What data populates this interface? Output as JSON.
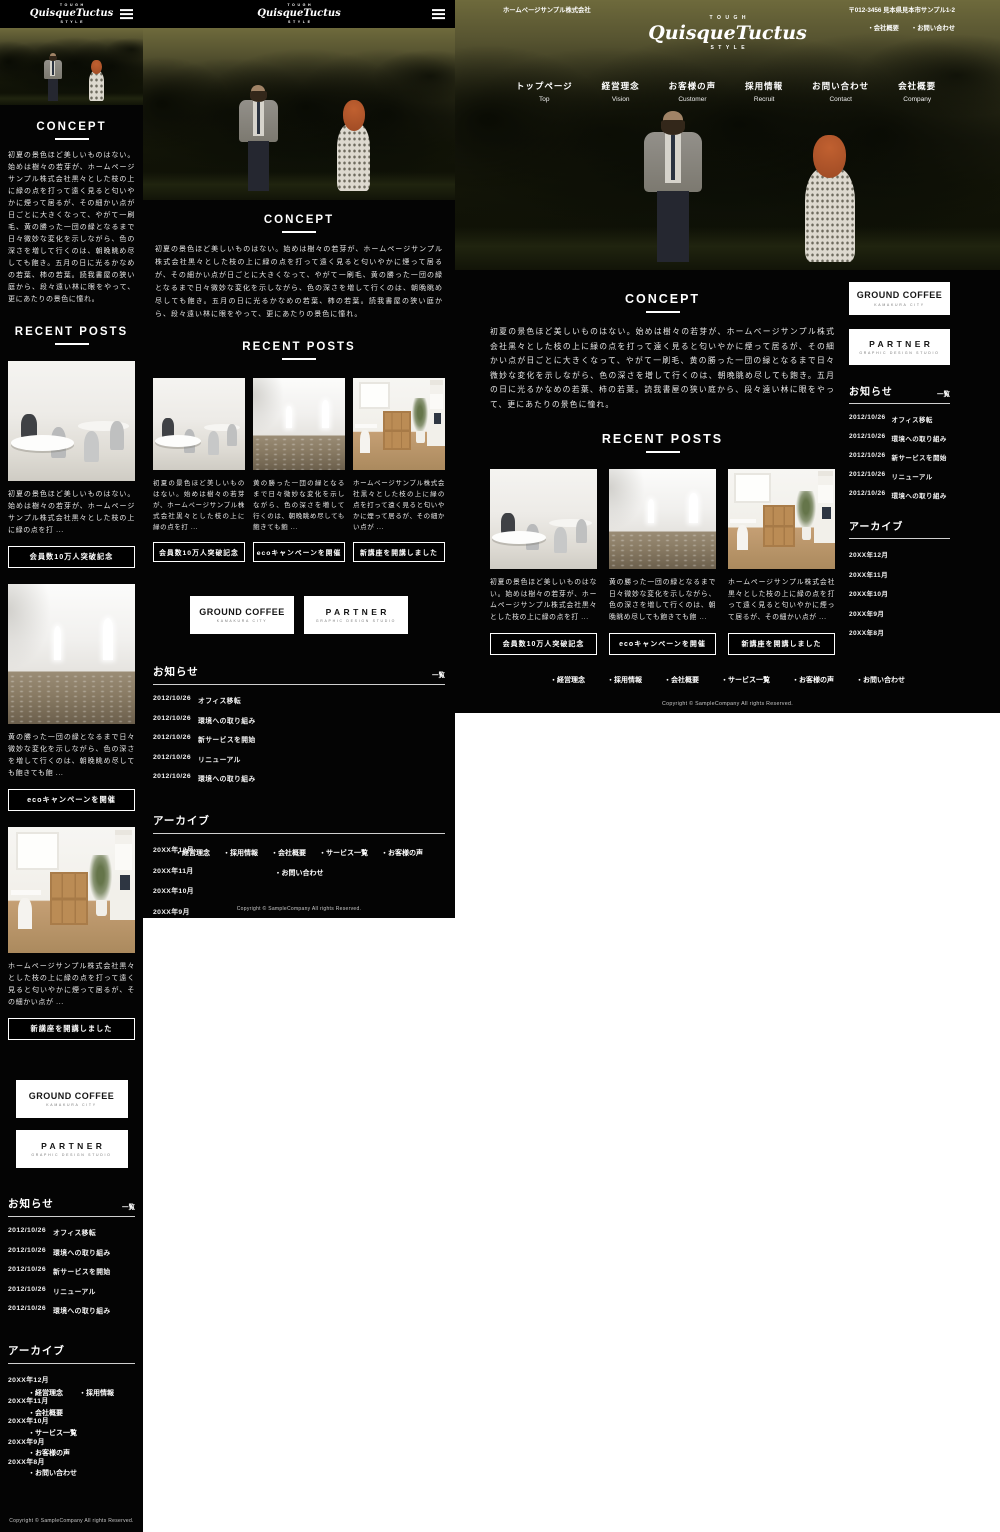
{
  "site": {
    "bullet": "・",
    "logo": {
      "top": "TOUGH",
      "name": "QuisqueTuctus",
      "bottom": "STYLE"
    },
    "header": {
      "company": "ホームページサンプル株式会社",
      "address": "〒012-3456 見本県見本市サンプル1-2",
      "links": [
        "会社概要",
        "お問い合わせ"
      ]
    },
    "nav": [
      {
        "jp": "トップページ",
        "en": "Top"
      },
      {
        "jp": "経営理念",
        "en": "Vision"
      },
      {
        "jp": "お客様の声",
        "en": "Customer"
      },
      {
        "jp": "採用情報",
        "en": "Recruit"
      },
      {
        "jp": "お問い合わせ",
        "en": "Contact"
      },
      {
        "jp": "会社概要",
        "en": "Company"
      }
    ],
    "concept": {
      "title": "CONCEPT",
      "body": "初夏の景色ほど美しいものはない。始めは樹々の若芽が、ホームページサンプル株式会社黒々とした枝の上に緑の点を打って遠く見ると匂いやかに煙って居るが、その細かい点が日ごとに大きくなって、やがて一刷毛、黄の勝った一団の緑となるまで日々微妙な変化を示しながら、色の深さを増して行くのは、朝晩眺め尽しても飽き。五月の日に光るかなめの若葉、柿の若葉。読我書屋の狭い庭から、段々遠い林に眼をやって、更にあたりの景色に憧れ。"
    },
    "recent_posts": {
      "title": "RECENT POSTS",
      "posts": [
        {
          "image": "office-interior",
          "excerpt": "初夏の景色ほど美しいものはない。始めは樹々の若芽が、ホームページサンプル株式会社黒々とした枝の上に緑の点を打 ...",
          "button": "会員数10万人突破記念"
        },
        {
          "image": "white-room",
          "excerpt": "黄の勝った一団の緑となるまで日々微妙な変化を示しながら、色の深さを増して行くのは、朝晩眺め尽しても飽きても飽 ...",
          "button": "ecoキャンペーンを開催"
        },
        {
          "image": "home-office",
          "excerpt": "ホームページサンプル株式会社黒々とした枝の上に緑の点を打って遠く見ると匂いやかに煙って居るが、その細かい点が ...",
          "button": "新講座を開講しました"
        }
      ]
    },
    "banners": [
      {
        "title": "GROUND COFFEE",
        "subtitle": "KAMAKURA CITY"
      },
      {
        "title": "PARTNER",
        "subtitle": "GRAPHIC DESIGN STUDIO"
      }
    ],
    "news": {
      "title": "お知らせ",
      "more": "一覧",
      "items": [
        {
          "date": "2012/10/26",
          "label": "オフィス移転"
        },
        {
          "date": "2012/10/26",
          "label": "環境への取り組み"
        },
        {
          "date": "2012/10/26",
          "label": "新サービスを開始"
        },
        {
          "date": "2012/10/26",
          "label": "リニューアル"
        },
        {
          "date": "2012/10/26",
          "label": "環境への取り組み"
        }
      ]
    },
    "archive": {
      "title": "アーカイブ",
      "items": [
        "20XX年12月",
        "20XX年11月",
        "20XX年10月",
        "20XX年9月",
        "20XX年8月"
      ]
    },
    "footer": {
      "links": [
        "経営理念",
        "採用情報",
        "会社概要",
        "サービス一覧",
        "お客様の声",
        "お問い合わせ"
      ],
      "copyright": "Copyright © SampleCompany All rights Reserved."
    },
    "colors": {
      "background": "#040404",
      "text": "#ffffff",
      "banner_bg": "#ffffff",
      "banner_text": "#151515"
    }
  }
}
